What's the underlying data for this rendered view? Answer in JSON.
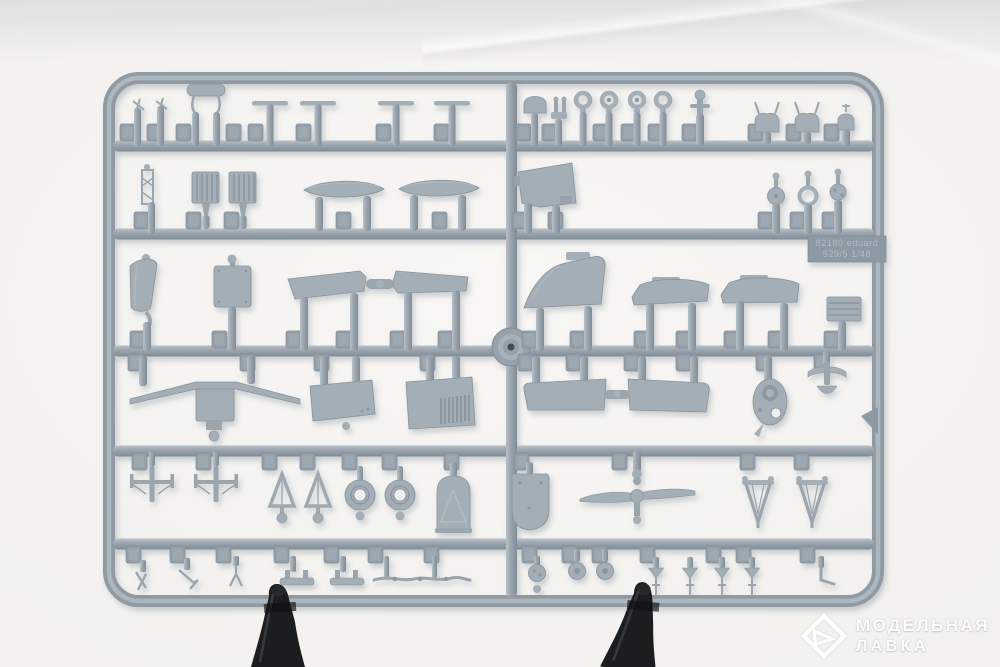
{
  "scene": {
    "subject": "gray injection-molded model kit sprue with aircraft parts",
    "holders": "two black clips supporting the sprue from below"
  },
  "sprue": {
    "color": "#9aa5ae",
    "grid": {
      "rows": 6,
      "columns": 2
    },
    "center_boss": "circular mold boss",
    "markings": {
      "line1": "82180 eduard",
      "line2": "529/5  1/48"
    },
    "parts_by_row": [
      [
        "antenna masts",
        "support frame",
        "pitot tubes",
        "dome fairing",
        "sight rings",
        "ball joint",
        "saddle mounts"
      ],
      [
        "boarding ladder",
        "radiator grilles",
        "drop tank",
        "drop tank",
        "cockpit panel",
        "gun-sight rings"
      ],
      [
        "armored seat back",
        "access hatch",
        "elevator halves",
        "tail fin",
        "flap halves",
        "radiator core"
      ],
      [
        "wing spar bar",
        "center-section box",
        "fuselage panel",
        "louvered cowl panel",
        "stabilizer halves",
        "engine-mount ring",
        "tail-wheel fork",
        "corner wedge"
      ],
      [
        "landing-gear legs",
        "A-frame struts",
        "main wheels",
        "tail-wheel door",
        "bulkhead shield",
        "two-blade propeller",
        "V-struts"
      ],
      [
        "small brackets",
        "bomb racks",
        "control rods",
        "hub with ball",
        "small wheels",
        "gear-strut darts",
        "step bracket"
      ]
    ]
  },
  "clamps": {
    "count": 2,
    "color": "#1c1d1f"
  },
  "watermark": {
    "line1": "МОДЕЛЬНАЯ",
    "line2": "ЛАВКА",
    "logo": "diamond-arrow emblem",
    "color": "#ffffff"
  }
}
